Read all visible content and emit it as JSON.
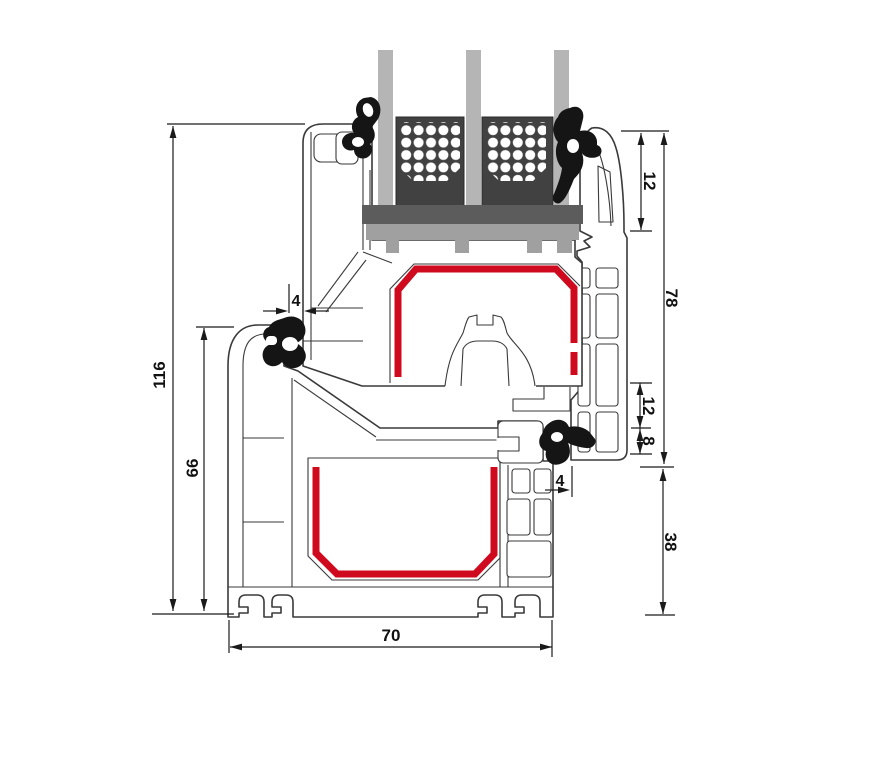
{
  "diagram": {
    "title": "window-profile-cross-section",
    "description": "Technical cross-section of a PVC window frame and sash with triple glazing, steel reinforcement and rubber seals",
    "colors": {
      "background": "#ffffff",
      "outline": "#3a3a3a",
      "steel_red": "#cf0a1e",
      "glass": "#b5b5b5",
      "spacer_dark": "#414141",
      "glazing_bridge": "#5c5c5c",
      "glazing_block": "#a0a0a0",
      "gasket_black": "#151515",
      "dimension": "#1a1a1a"
    },
    "dimensions": {
      "total_height": {
        "value": "116"
      },
      "lower_height": {
        "value": "66"
      },
      "gap_left": {
        "value": "4"
      },
      "overlap_top": {
        "value": "12"
      },
      "sash_face_height": {
        "value": "78"
      },
      "rebate_mid": {
        "value": "12"
      },
      "gasket_groove": {
        "value": "8"
      },
      "gap_right": {
        "value": "4"
      },
      "frame_face_height": {
        "value": "38"
      },
      "build_depth": {
        "value": "70"
      }
    }
  }
}
